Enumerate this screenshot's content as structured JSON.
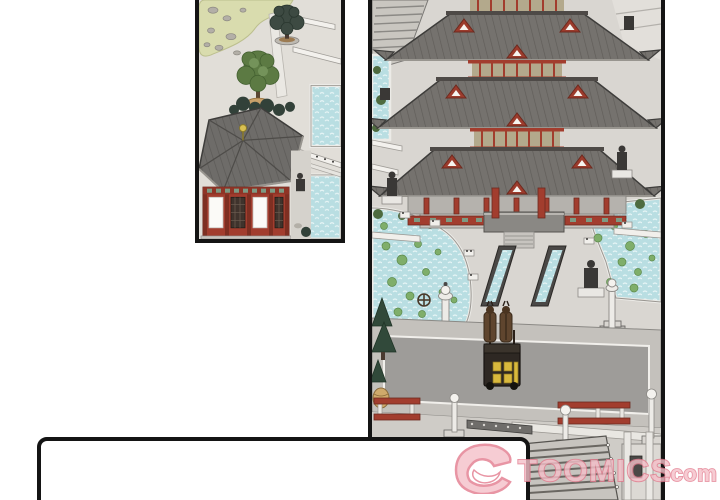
{
  "watermark": {
    "icon_name": "devil-horns-icon",
    "brand_text": "TOOMICS",
    "domain_suffix": ".com",
    "fill_color": "#f5c0c9",
    "outline_color": "#e37b8e"
  },
  "palette": {
    "page_background": "#ffffff",
    "panel_border": "#141414",
    "roof_gray": "#6e6c69",
    "roof_ridge": "#4e4a47",
    "temple_red": "#a23d2e",
    "gable_red": "#9c3b2c",
    "clerestory_tan": "#b3a98c",
    "railing_green": "#7d9a83",
    "water_blue": "#b9dee2",
    "lily_pad_green": "#7fae6a",
    "pavement_light": "#d9d6d1",
    "road_gray": "#9e9c99",
    "plaza_gray": "#cfccc7",
    "foliage_green": "#5c7a43",
    "pine_green": "#31493a",
    "garden_moss_green": "#d9dcae",
    "horse_brown": "#5f452e",
    "carriage_dark": "#2e2823",
    "carriage_window_yellow": "#d9b93d",
    "finial_gold": "#d9c052",
    "speech_panel_fill": "#ffffff"
  }
}
